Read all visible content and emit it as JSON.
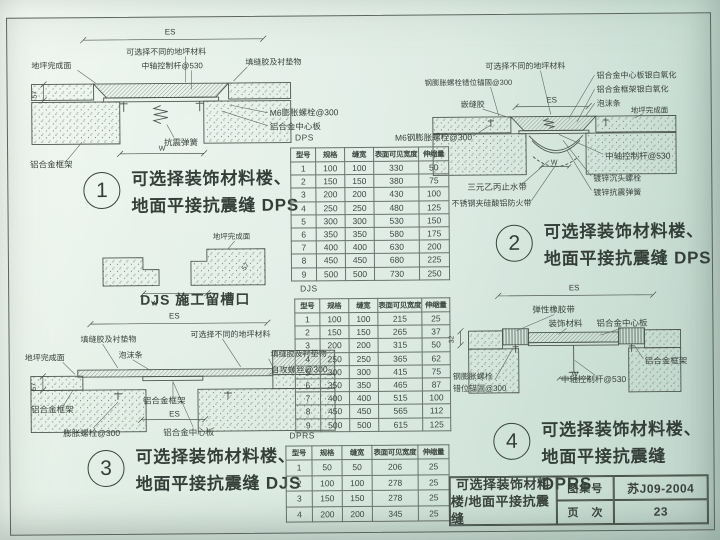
{
  "captions": {
    "c1": {
      "num": "1",
      "line1": "可选择装饰材料楼、",
      "line2": "地面平接抗震缝 DPS"
    },
    "c2": {
      "num": "2",
      "line1": "可选择装饰材料楼、",
      "line2": "地面平接抗震缝 DPS"
    },
    "c3": {
      "num": "3",
      "line1": "可选择装饰材料楼、",
      "line2": "地面平接抗震缝 DJS"
    },
    "c4": {
      "num": "4",
      "line1": "可选择装饰材料楼、",
      "line2": "地面平接抗震缝 DPRS"
    }
  },
  "titleblock": {
    "title_line1": "可选择装饰材料",
    "title_line2": "楼/地面平接抗震缝",
    "atlas_label": "图集号",
    "atlas_no": "苏J09-2004",
    "page_label": "页　次",
    "page_no": "23"
  },
  "d1": {
    "es": "ES",
    "w": "W",
    "dim57": "57",
    "floor_finish": "地坪完成面",
    "optional_material": "可选择不同的地坪材料",
    "control_rod": "中轴控制杆@530",
    "sealant": "填缝胶及衬垫物",
    "m6_bolt": "M6膨胀螺栓@300",
    "spring": "抗震弹簧",
    "frame": "铝合金框架",
    "center_plate": "铝合金中心板"
  },
  "groove": {
    "floor_finish": "地坪完成面",
    "dim57": "57",
    "w": "W",
    "w136": "136",
    "caption": "DJS 施工留槽口"
  },
  "d2": {
    "es": "ES",
    "w": "W",
    "optional_material": "可选择不同的地坪材料",
    "anchor_bolt": "钢膨胀螺栓错位锚固@300",
    "caulk": "嵌缝胶",
    "center_plate_ox": "铝合金中心板银白氧化",
    "frame_ox": "铝合金框架银白氧化",
    "foam": "泡沫条",
    "floor_finish": "地坪完成面",
    "m6_bolt": "M6钢膨胀螺栓@300",
    "control_rod": "中轴控制杆@530",
    "sunk_bolt": "镀锌沉头螺栓",
    "spring": "镀锌抗震弹簧",
    "waterstop": "三元乙丙止水带",
    "fire_band": "不锈钢夹硅酸铝防火带"
  },
  "d3": {
    "es_top": "ES",
    "es_inner": "ES",
    "dim57": "57",
    "sealant_left": "填缝胶及衬垫物",
    "foam": "泡沫条",
    "optional_material": "可选择不同的地坪材料",
    "sealant_right": "填缝胶及衬垫物",
    "screw": "自攻螺丝@300",
    "floor_finish": "地坪完成面",
    "frame_left": "铝合金框架",
    "frame_mid": "铝合金框架",
    "bolt": "膨胀螺栓@300",
    "center_plate": "铝合金中心板"
  },
  "d4": {
    "es": "ES",
    "w": "W",
    "dim32": "32",
    "rubber": "弹性橡胶带",
    "deco": "装饰材料",
    "center_plate": "铝合金中心板",
    "frame": "铝合金框架",
    "control_rod": "中轴控制杆@530",
    "anchor_line1": "钢膨胀螺栓",
    "anchor_line2": "错位锚固@300"
  },
  "tables": {
    "dps": {
      "name": "DPS",
      "headers": [
        "型号",
        "规格",
        "缝宽",
        "表面可见宽度",
        "伸缩量"
      ],
      "rows": [
        [
          1,
          100,
          100,
          330,
          50
        ],
        [
          2,
          150,
          150,
          380,
          75
        ],
        [
          3,
          200,
          200,
          430,
          100
        ],
        [
          4,
          250,
          250,
          480,
          125
        ],
        [
          5,
          300,
          300,
          530,
          150
        ],
        [
          6,
          350,
          350,
          580,
          175
        ],
        [
          7,
          400,
          400,
          630,
          200
        ],
        [
          8,
          450,
          450,
          680,
          225
        ],
        [
          9,
          500,
          500,
          730,
          250
        ]
      ]
    },
    "djs": {
      "name": "DJS",
      "headers": [
        "型号",
        "规格",
        "缝宽",
        "表面可见宽度",
        "伸缩量"
      ],
      "rows": [
        [
          1,
          100,
          100,
          215,
          25
        ],
        [
          2,
          150,
          150,
          265,
          37
        ],
        [
          3,
          200,
          200,
          315,
          50
        ],
        [
          4,
          250,
          250,
          365,
          62
        ],
        [
          5,
          300,
          300,
          415,
          75
        ],
        [
          6,
          350,
          350,
          465,
          87
        ],
        [
          7,
          400,
          400,
          515,
          100
        ],
        [
          8,
          450,
          450,
          565,
          112
        ],
        [
          9,
          500,
          500,
          615,
          125
        ]
      ]
    },
    "dprs": {
      "name": "DPRS",
      "headers": [
        "型号",
        "规格",
        "缝宽",
        "表面可见宽度",
        "伸缩量"
      ],
      "rows": [
        [
          1,
          50,
          50,
          206,
          25
        ],
        [
          2,
          100,
          100,
          278,
          25
        ],
        [
          3,
          150,
          150,
          278,
          25
        ],
        [
          4,
          200,
          200,
          345,
          25
        ]
      ]
    }
  }
}
